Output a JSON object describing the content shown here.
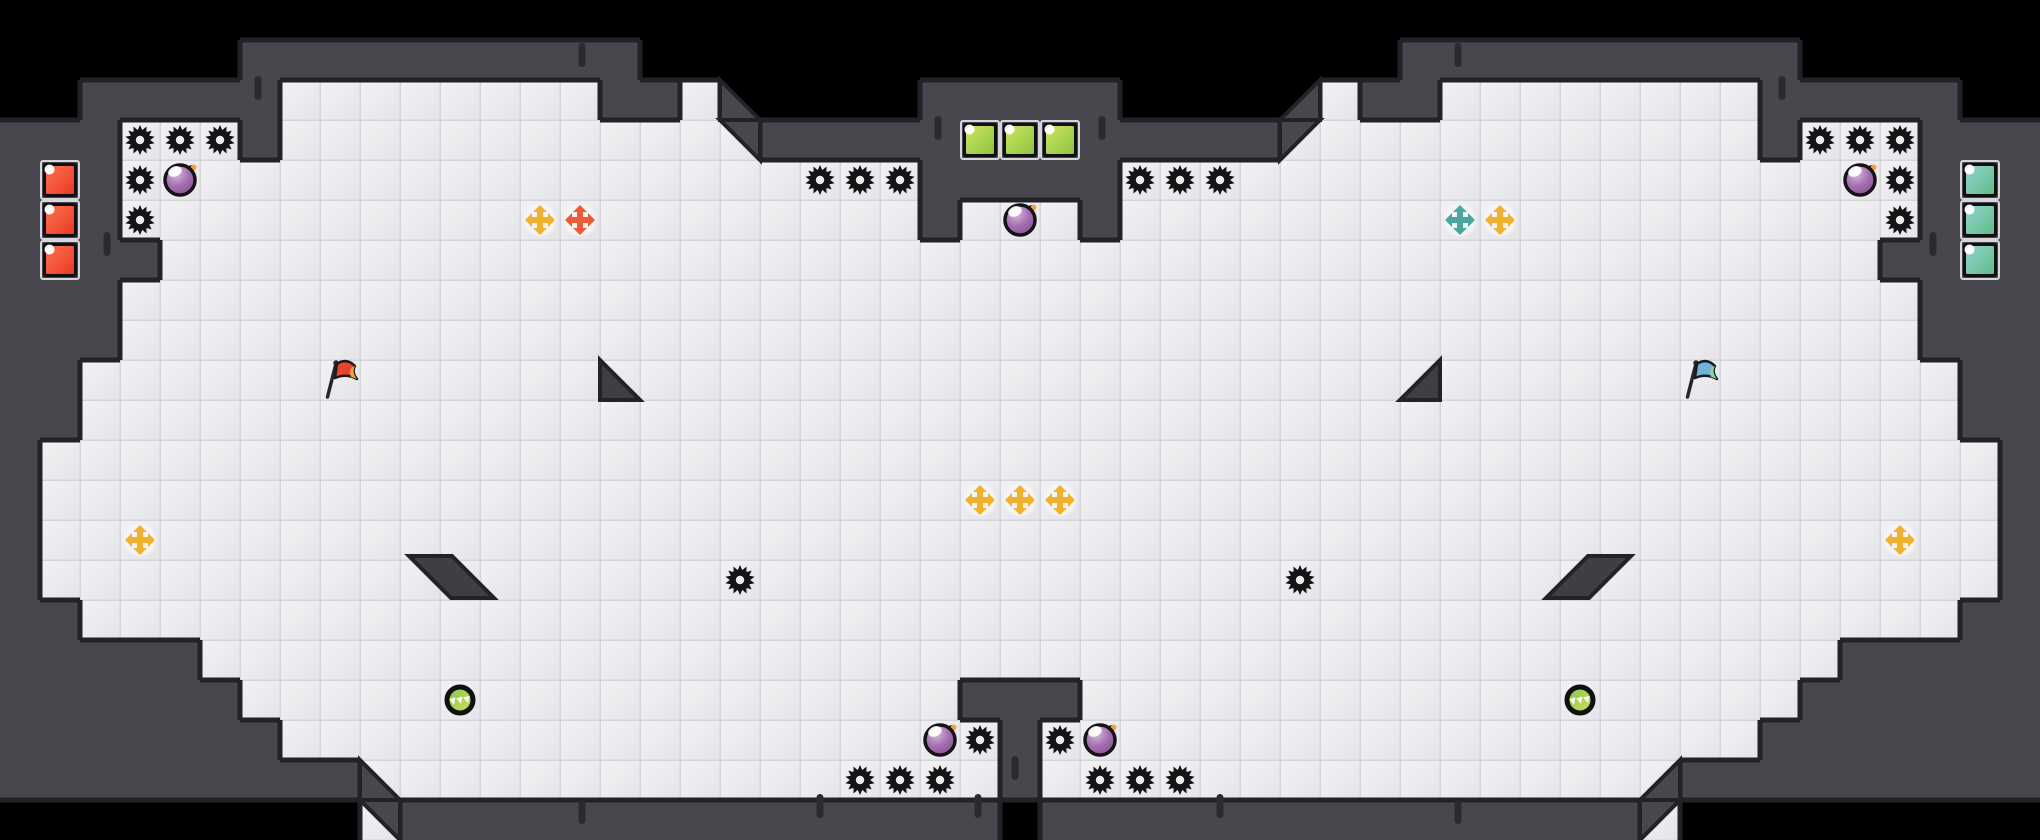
{
  "canvas": {
    "width": 2040,
    "height": 840,
    "tile": 40,
    "cols": 51,
    "rows": 21
  },
  "colors": {
    "outside": "#000000",
    "wall": "#47474d",
    "outline": "#232228",
    "tile_light": "#f3f3f5",
    "tile_dark": "#e4e4e8",
    "tile_seam": "#d4d4da",
    "ramp": "#3e3e44",
    "dash": "#2a2a30",
    "gear": "#141417",
    "gear_hole": "#ebebee",
    "arrow_bg": "#f6f6f8",
    "arrow_palette": {
      "yellow": "#f3b02c",
      "orange": "#ec5a38",
      "teal": "#4aa7a0"
    },
    "bomb": {
      "stroke": "#141418",
      "grad": [
        "#d6bbda",
        "#a56fb2",
        "#7e4a84"
      ],
      "highlight": "#ffffff",
      "spark": "#f4a336"
    },
    "coin": {
      "ring": "#101012",
      "grad": [
        "#7cc94e",
        "#dcdb55"
      ],
      "marks": "#ffffff"
    },
    "flag_red": {
      "cloth": "#e8432d",
      "tip": "#f2a33c",
      "pole": "#26262a"
    },
    "flag_blue": {
      "cloth": "#6fb3d8",
      "tip": "#8bd3a0",
      "pole": "#26262a"
    },
    "block_palette": {
      "red": [
        "#fb7150",
        "#e93a20"
      ],
      "green": [
        "#cde564",
        "#8ec33c"
      ],
      "teal": [
        "#92d3cf",
        "#5fbd86"
      ]
    }
  },
  "grid": [
    "...................................................",
    "......##########...................##########......",
    "..#####--------##-.....#####.....-##--------#####..",
    "###---#------------#############------------#---###",
    "###--------------------#####--------------------###",
    "###--------------------#---#--------------------###",
    "####-------------------------------------------####",
    "###---------------------------------------------###",
    "###---------------------------------------------###",
    "##-----------------------------------------------##",
    "##-----------------------------------------------##",
    "#-------------------------------------------------#",
    "#-------------------------------------------------#",
    "#-------------------------------------------------#",
    "#-------------------------------------------------#",
    "##-----------------------------------------------##",
    "#####-----------------------------------------#####",
    "######------------------###------------------######",
    "#######------------------#------------------#######",
    "#########----------------#----------------#########",
    ".........-###############.###############-........."
  ],
  "wall_triangles": [
    [
      720,
      80,
      760,
      120,
      720,
      120
    ],
    [
      720,
      120,
      760,
      120,
      760,
      160
    ],
    [
      1320,
      80,
      1280,
      120,
      1320,
      120
    ],
    [
      1320,
      120,
      1280,
      120,
      1280,
      160
    ],
    [
      360,
      760,
      400,
      800,
      360,
      800
    ],
    [
      360,
      800,
      400,
      800,
      400,
      840
    ],
    [
      1680,
      760,
      1640,
      800,
      1680,
      800
    ],
    [
      1680,
      800,
      1640,
      800,
      1640,
      840
    ]
  ],
  "ramps": {
    "triangles": [
      [
        600,
        360,
        640,
        400,
        600,
        400
      ],
      [
        1440,
        360,
        1400,
        400,
        1440,
        400
      ]
    ],
    "parallelograms": [
      [
        409,
        556,
        452,
        556,
        494,
        598,
        451,
        598
      ],
      [
        1631,
        556,
        1588,
        556,
        1546,
        598,
        1589,
        598
      ]
    ]
  },
  "sprites": {
    "gears": [
      [
        3,
        3
      ],
      [
        4,
        3
      ],
      [
        5,
        3
      ],
      [
        3,
        4
      ],
      [
        3,
        5
      ],
      [
        45,
        3
      ],
      [
        46,
        3
      ],
      [
        47,
        3
      ],
      [
        47,
        4
      ],
      [
        47,
        5
      ],
      [
        20,
        4
      ],
      [
        21,
        4
      ],
      [
        22,
        4
      ],
      [
        28,
        4
      ],
      [
        29,
        4
      ],
      [
        30,
        4
      ],
      [
        18,
        14
      ],
      [
        32,
        14
      ],
      [
        24,
        18
      ],
      [
        26,
        18
      ],
      [
        21,
        19
      ],
      [
        22,
        19
      ],
      [
        23,
        19
      ],
      [
        27,
        19
      ],
      [
        28,
        19
      ],
      [
        29,
        19
      ]
    ],
    "bombs": [
      [
        4,
        4
      ],
      [
        46,
        4
      ],
      [
        25,
        5
      ],
      [
        23,
        18
      ],
      [
        27,
        18
      ]
    ],
    "arrows": [
      {
        "c": 13,
        "r": 5,
        "color": "yellow"
      },
      {
        "c": 14,
        "r": 5,
        "color": "orange"
      },
      {
        "c": 36,
        "r": 5,
        "color": "teal"
      },
      {
        "c": 37,
        "r": 5,
        "color": "yellow"
      },
      {
        "c": 24,
        "r": 12,
        "color": "yellow"
      },
      {
        "c": 25,
        "r": 12,
        "color": "yellow"
      },
      {
        "c": 26,
        "r": 12,
        "color": "yellow"
      },
      {
        "c": 3,
        "r": 13,
        "color": "yellow"
      },
      {
        "c": 47,
        "r": 13,
        "color": "yellow"
      }
    ],
    "flags": [
      {
        "c": 8,
        "r": 9,
        "variant": "flag_red"
      },
      {
        "c": 42,
        "r": 9,
        "variant": "flag_blue"
      }
    ],
    "coins": [
      [
        11,
        17
      ],
      [
        39,
        17
      ]
    ],
    "blocks": [
      {
        "c": 1,
        "r": 4,
        "color": "red"
      },
      {
        "c": 1,
        "r": 5,
        "color": "red"
      },
      {
        "c": 1,
        "r": 6,
        "color": "red"
      },
      {
        "c": 24,
        "r": 3,
        "color": "green"
      },
      {
        "c": 25,
        "r": 3,
        "color": "green"
      },
      {
        "c": 26,
        "r": 3,
        "color": "green"
      },
      {
        "c": 49,
        "r": 4,
        "color": "teal"
      },
      {
        "c": 49,
        "r": 5,
        "color": "teal"
      },
      {
        "c": 49,
        "r": 6,
        "color": "teal"
      }
    ]
  },
  "dashes": [
    [
      258,
      88
    ],
    [
      1782,
      88
    ],
    [
      582,
      55
    ],
    [
      1458,
      55
    ],
    [
      938,
      128
    ],
    [
      1102,
      128
    ],
    [
      107,
      244
    ],
    [
      1933,
      244
    ],
    [
      1015,
      768
    ],
    [
      978,
      806
    ],
    [
      820,
      806
    ],
    [
      1220,
      806
    ],
    [
      582,
      812
    ],
    [
      1458,
      812
    ]
  ]
}
